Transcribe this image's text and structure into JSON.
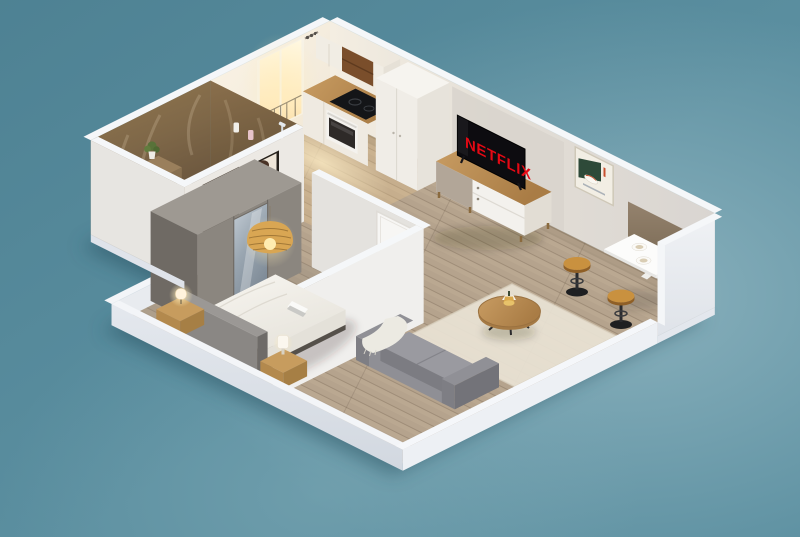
{
  "scene": {
    "kind": "isometric-apartment-cutaway-render",
    "regions": [
      "bathroom",
      "kitchen",
      "living-room",
      "dining-nook",
      "bedroom"
    ],
    "tv": {
      "brand_text": "NETFLIX",
      "brand_color": "#E50914",
      "screen_color": "#0D0C10"
    },
    "palette": {
      "background": "#5B8FA0",
      "background_glow": "#A3C3CC",
      "wall_white": "#EFEDE8",
      "wall_top": "#F5F7F9",
      "floor_wood": "#B7A48D",
      "bathroom_marble_wall": "#7E6748",
      "bathroom_marble_floor": "#74603F",
      "concrete_wardrobe": "#8B867F",
      "furniture_wood": "#C09258",
      "sofa_gray": "#8F8F95",
      "rug_cream": "#E9E3D5",
      "rattan_lamp": "#D9A653",
      "stool_wood": "#C9913F",
      "poster_green": "#2E4A39",
      "dining_panel_brown": "#8A7866",
      "window_light": "#FFE9BC",
      "bed_duvet": "#F4F2ED",
      "headboard_gray": "#8A8784",
      "plinth_white": "#E8EBEF"
    }
  }
}
